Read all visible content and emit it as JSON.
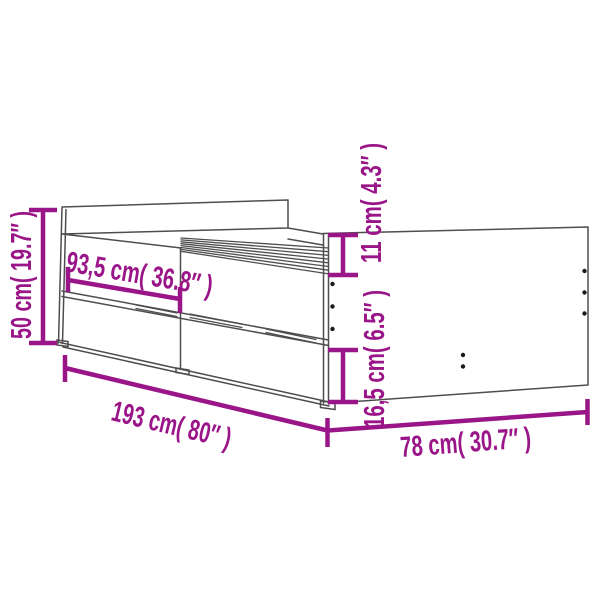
{
  "diagram": {
    "kind": "product-dimension-diagram",
    "subject": "bed-frame-with-drawers",
    "colors": {
      "background": "#ffffff",
      "outline": "#4e4e4e",
      "dimension": "#9A1588",
      "dots": "#1a1a1a"
    },
    "labels": {
      "overall_height": "50 cm( 19.7″ )",
      "drawer_section_width": "93,5 cm( 36.8″ )",
      "footboard_above_base": "11 cm( 4.3″ )",
      "drawer_front_height": "16,5 cm( 6.5″ )",
      "total_length": "193 cm( 80″ )",
      "total_width": "78 cm( 30.7″ )"
    }
  }
}
